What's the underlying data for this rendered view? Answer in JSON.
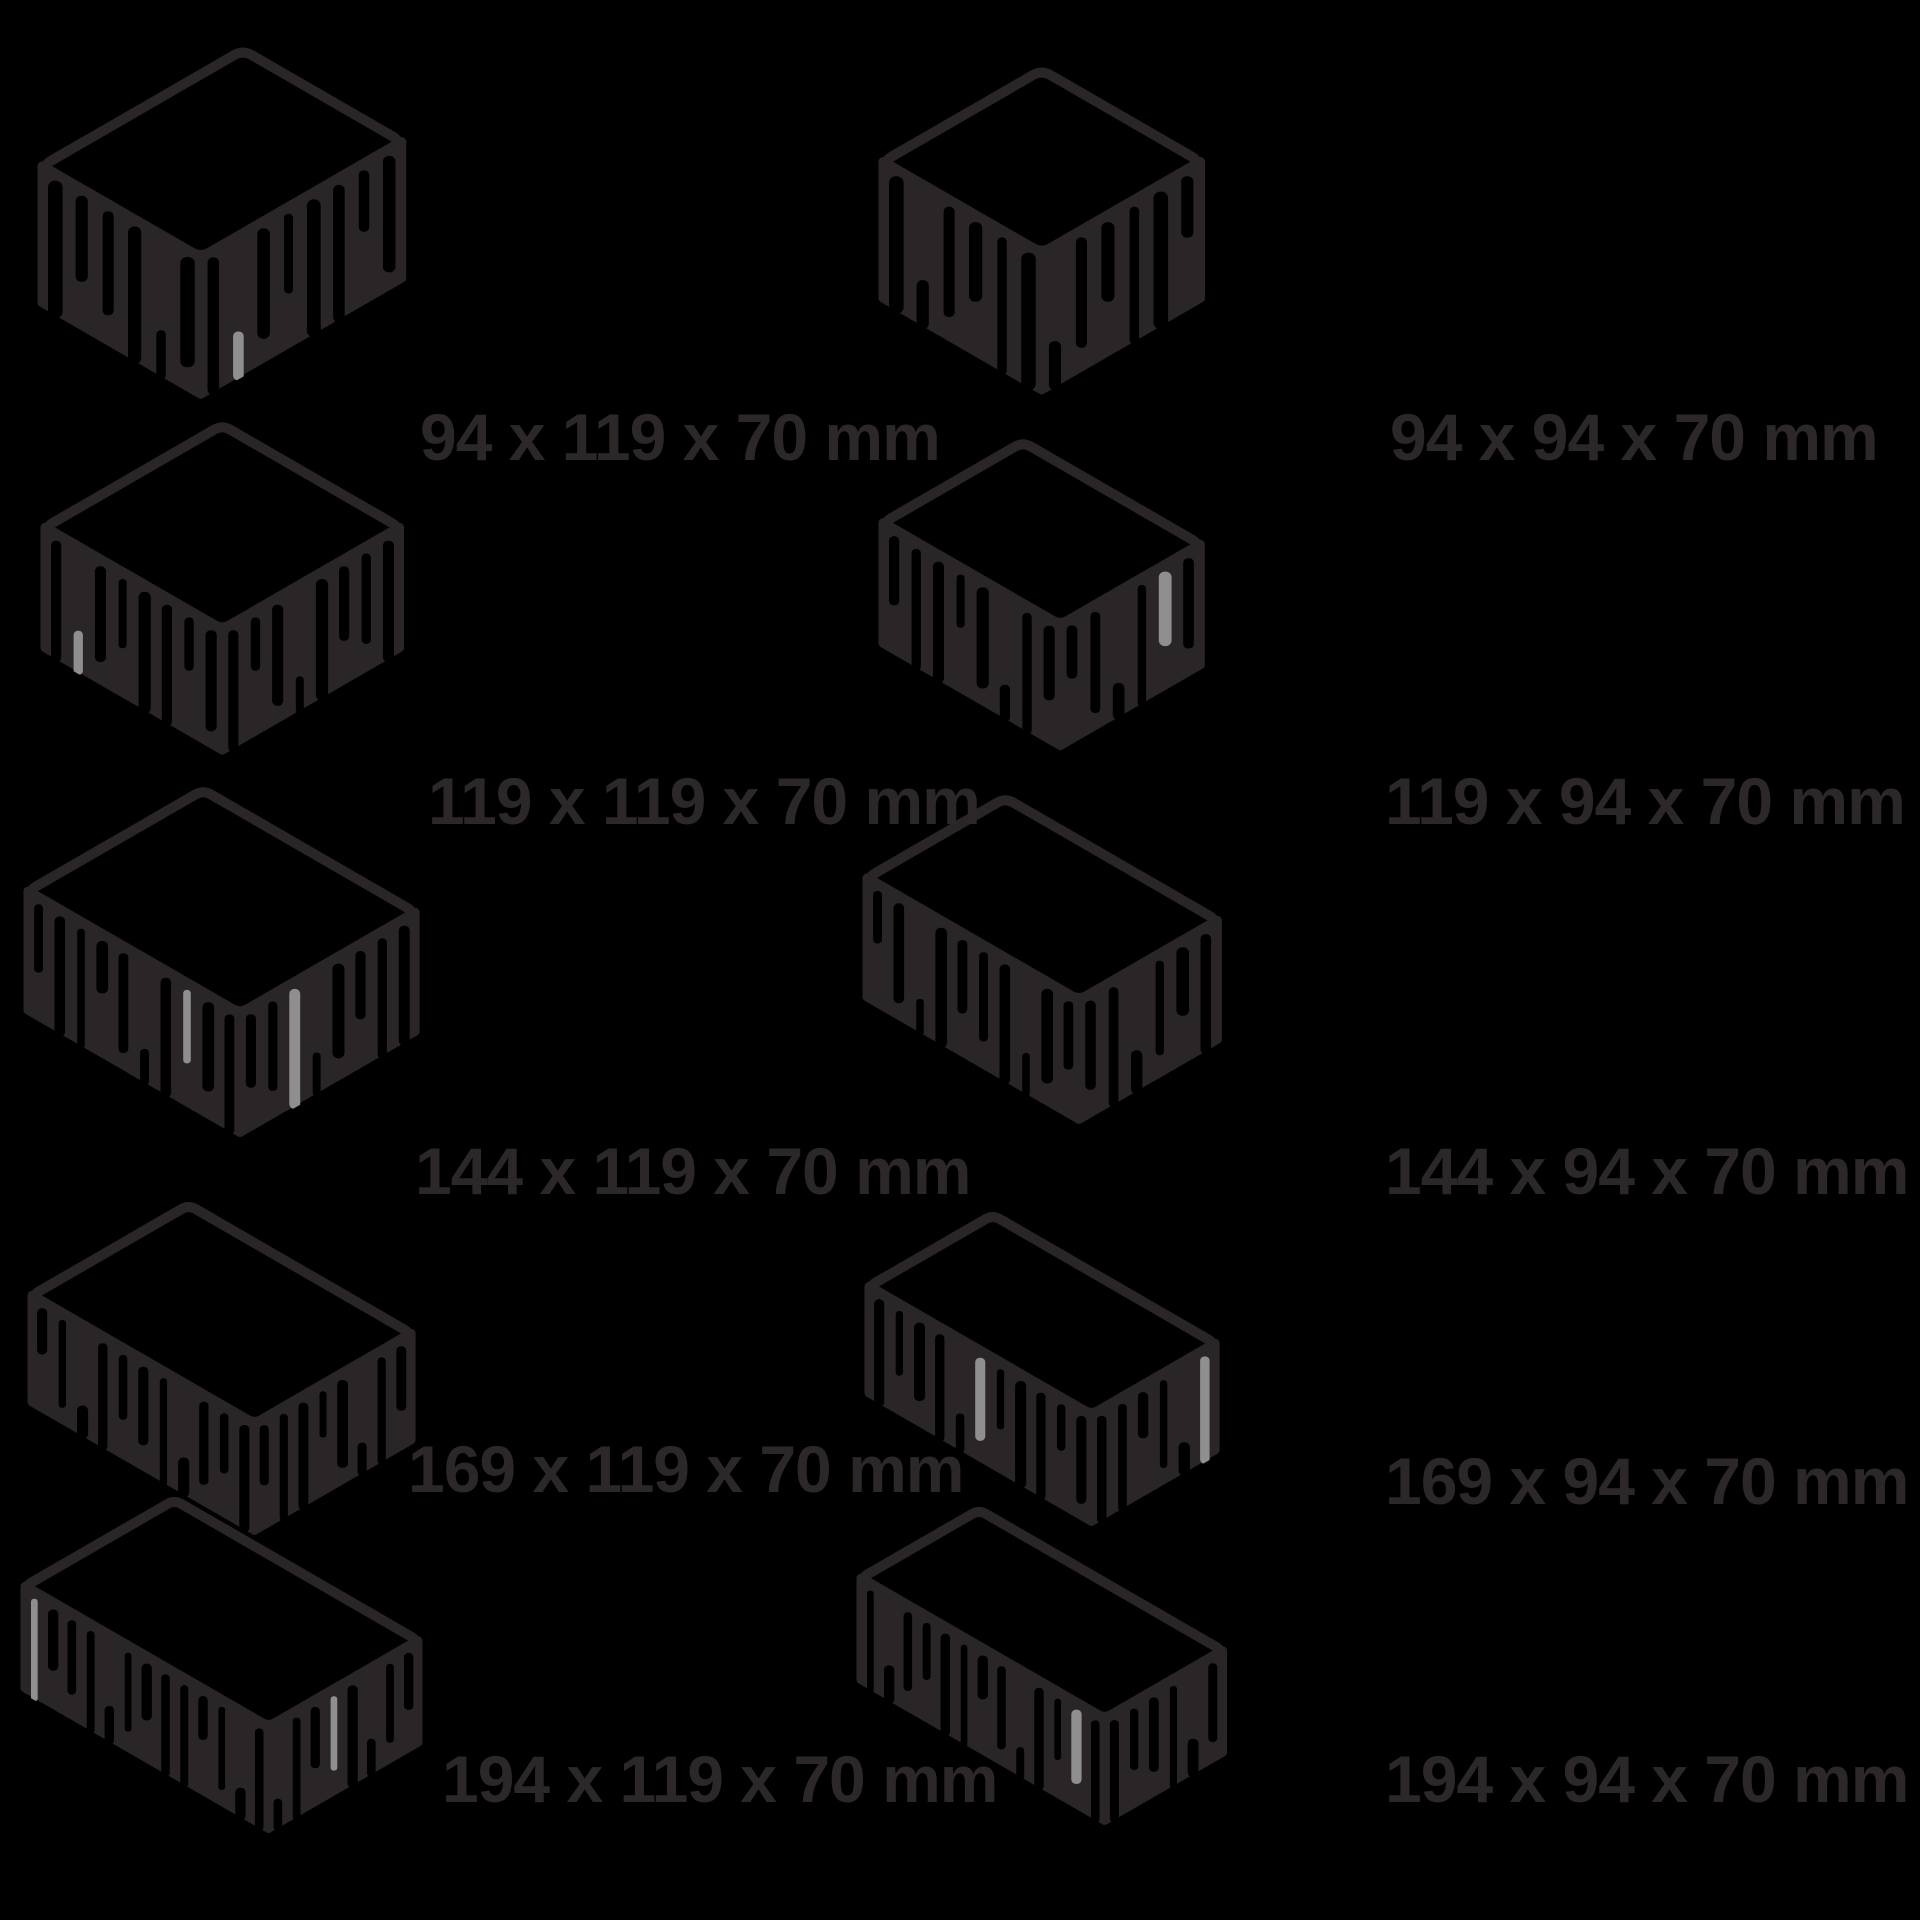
{
  "diagram_title": "paving-stone-size-chart",
  "unit": "mm",
  "colors": {
    "background": "#000000",
    "ink": "#2a2627",
    "highlight": "#8f8f8f"
  },
  "columns": [
    {
      "id": "left",
      "common_width_mm": 119,
      "stones": [
        {
          "label": "94 x 119 x 70 mm",
          "length_mm": 94,
          "width_mm": 119,
          "height_mm": 70
        },
        {
          "label": "119 x 119 x 70 mm",
          "length_mm": 119,
          "width_mm": 119,
          "height_mm": 70
        },
        {
          "label": "144 x 119 x 70 mm",
          "length_mm": 144,
          "width_mm": 119,
          "height_mm": 70
        },
        {
          "label": "169 x 119 x 70 mm",
          "length_mm": 169,
          "width_mm": 119,
          "height_mm": 70
        },
        {
          "label": "194 x 119 x 70 mm",
          "length_mm": 194,
          "width_mm": 119,
          "height_mm": 70
        }
      ]
    },
    {
      "id": "right",
      "common_width_mm": 94,
      "stones": [
        {
          "label": "94 x 94 x 70 mm",
          "length_mm": 94,
          "width_mm": 94,
          "height_mm": 70
        },
        {
          "label": "119 x 94 x 70 mm",
          "length_mm": 119,
          "width_mm": 94,
          "height_mm": 70
        },
        {
          "label": "144 x 94 x 70 mm",
          "length_mm": 144,
          "width_mm": 94,
          "height_mm": 70
        },
        {
          "label": "169 x 94 x 70 mm",
          "length_mm": 169,
          "width_mm": 94,
          "height_mm": 70
        },
        {
          "label": "194 x 94 x 70 mm",
          "length_mm": 194,
          "width_mm": 94,
          "height_mm": 70
        }
      ]
    }
  ]
}
